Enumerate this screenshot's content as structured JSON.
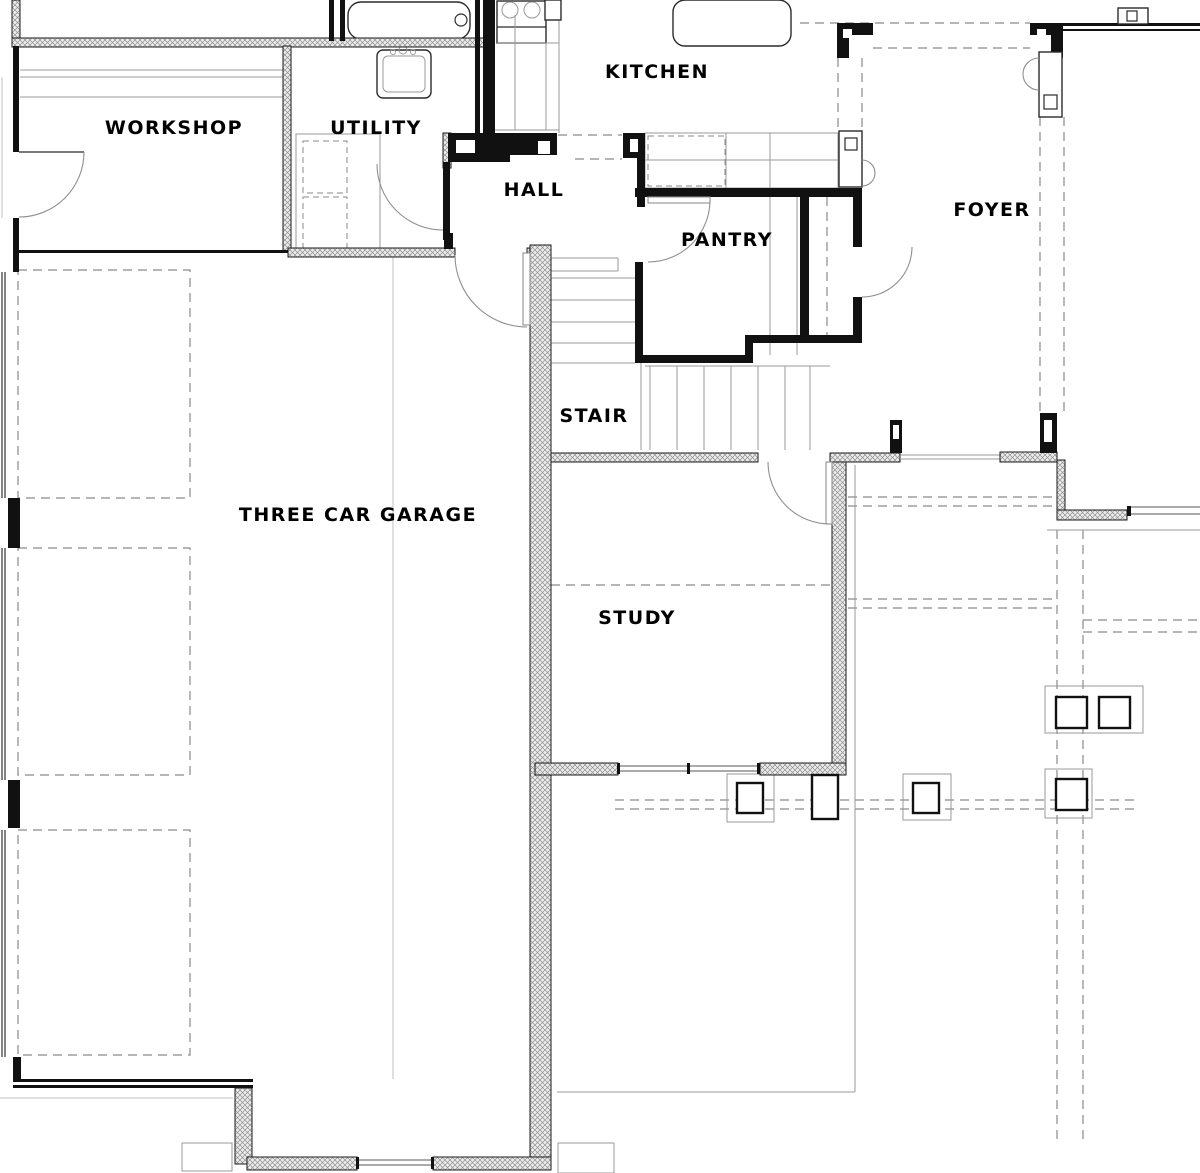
{
  "document": {
    "kind": "architectural floor plan (first floor, partial view)",
    "background": "#ffffff"
  },
  "colors": {
    "wall_black": "#111111",
    "wall_hatch_line": "#8f8f8f",
    "thin_gray": "#9a9a9a",
    "dash_gray": "#8a8a8a",
    "label_text": "#000000"
  },
  "rooms": [
    {
      "id": "workshop",
      "label": "WORKSHOP"
    },
    {
      "id": "utility",
      "label": "UTILITY"
    },
    {
      "id": "kitchen",
      "label": "KITCHEN"
    },
    {
      "id": "hall",
      "label": "HALL"
    },
    {
      "id": "pantry",
      "label": "PANTRY"
    },
    {
      "id": "foyer",
      "label": "FOYER"
    },
    {
      "id": "stair",
      "label": "STAIR"
    },
    {
      "id": "garage",
      "label": "THREE CAR GARAGE"
    },
    {
      "id": "study",
      "label": "STUDY"
    }
  ],
  "fixtures": [
    {
      "id": "bathtub",
      "name": "bathtub with faucet"
    },
    {
      "id": "utility-sink",
      "name": "utility laundry sink"
    },
    {
      "id": "washer-dryer",
      "name": "washer / dryer (dashed)"
    },
    {
      "id": "range",
      "name": "kitchen range with two burners"
    },
    {
      "id": "island",
      "name": "kitchen island"
    },
    {
      "id": "counters",
      "name": "kitchen counters"
    },
    {
      "id": "lockers",
      "name": "hall locker / cubby niche"
    },
    {
      "id": "posts",
      "name": "porch columns"
    },
    {
      "id": "garage-bays",
      "name": "three dashed parking bays"
    },
    {
      "id": "stair-treads",
      "name": "L-shaped stair treads"
    }
  ]
}
